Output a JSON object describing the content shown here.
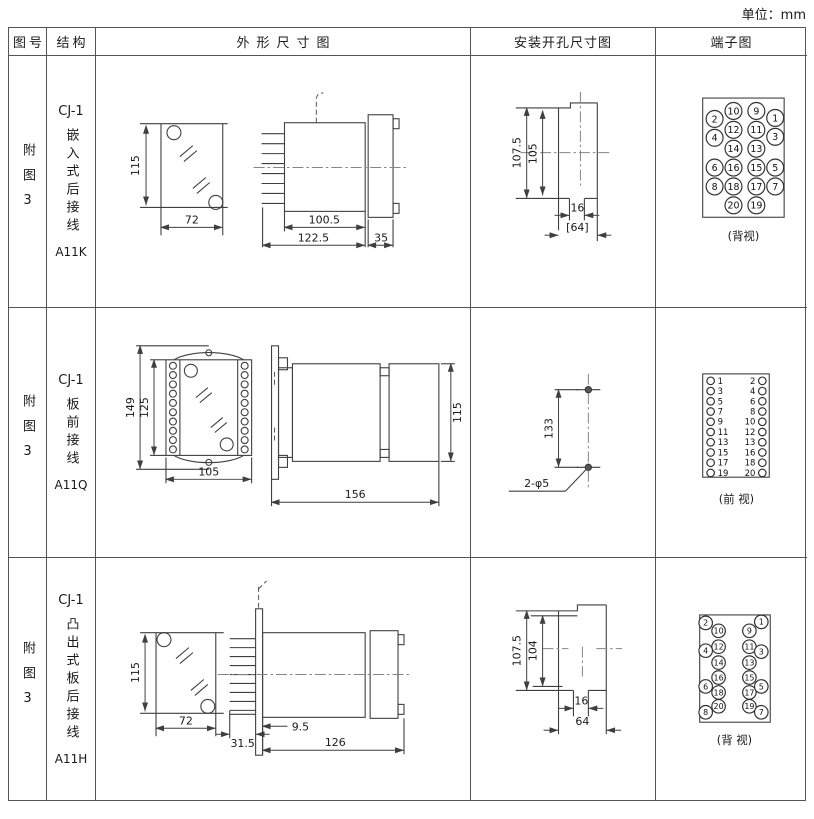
{
  "unit_label": "单位：mm",
  "headers": {
    "fig": "图号",
    "structure": "结构",
    "outline": "外形尺寸图",
    "mounting": "安装开孔尺寸图",
    "terminal": "端子图"
  },
  "rows": [
    {
      "fig_label": "附图3",
      "model": "CJ-1",
      "structure": "嵌入式后接线",
      "code": "A11K",
      "outline": {
        "height": "115",
        "width": "72",
        "body_length": "100.5",
        "total_length": "122.5",
        "flange_depth": "35"
      },
      "mounting": {
        "outer_height": "107.5",
        "inner_height": "105",
        "notch_width": "16",
        "total_width": "[64]"
      },
      "terminal": {
        "caption": "(背视)",
        "inner_left": [
          "10",
          "12",
          "14",
          "16",
          "18",
          "20"
        ],
        "inner_right": [
          "9",
          "11",
          "13",
          "15",
          "17",
          "19"
        ],
        "outer_left": [
          "2",
          "4",
          "6",
          "8"
        ],
        "outer_right": [
          "1",
          "3",
          "5",
          "7"
        ]
      }
    },
    {
      "fig_label": "附图3",
      "model": "CJ-1",
      "structure": "板前接线",
      "code": "A11Q",
      "outline": {
        "outer_height": "149",
        "inner_height": "125",
        "width": "105",
        "length": "156",
        "rear_height": "115"
      },
      "mounting": {
        "hole_spacing": "133",
        "hole_label": "2-φ5"
      },
      "terminal": {
        "caption": "(前 视)",
        "left": [
          "1",
          "3",
          "5",
          "7",
          "9",
          "11",
          "13",
          "15",
          "17",
          "19"
        ],
        "right": [
          "2",
          "4",
          "6",
          "8",
          "10",
          "12",
          "13",
          "16",
          "18",
          "20"
        ]
      }
    },
    {
      "fig_label": "附图3",
      "model": "CJ-1",
      "structure": "凸出式板后接线",
      "code": "A11H",
      "outline": {
        "height": "115",
        "width": "72",
        "pin_length": "31.5",
        "offset": "9.5",
        "length": "126"
      },
      "mounting": {
        "outer_height": "107.5",
        "inner_height": "104",
        "notch_width": "16",
        "total_width": "64"
      },
      "terminal": {
        "caption": "(背 视)",
        "inner_left": [
          "10",
          "12",
          "14",
          "16",
          "18",
          "20"
        ],
        "inner_right": [
          "9",
          "11",
          "13",
          "15",
          "17",
          "19"
        ],
        "outer_left": [
          "2",
          "4",
          "6",
          "8"
        ],
        "outer_right": [
          "1",
          "3",
          "5",
          "7"
        ]
      }
    }
  ]
}
